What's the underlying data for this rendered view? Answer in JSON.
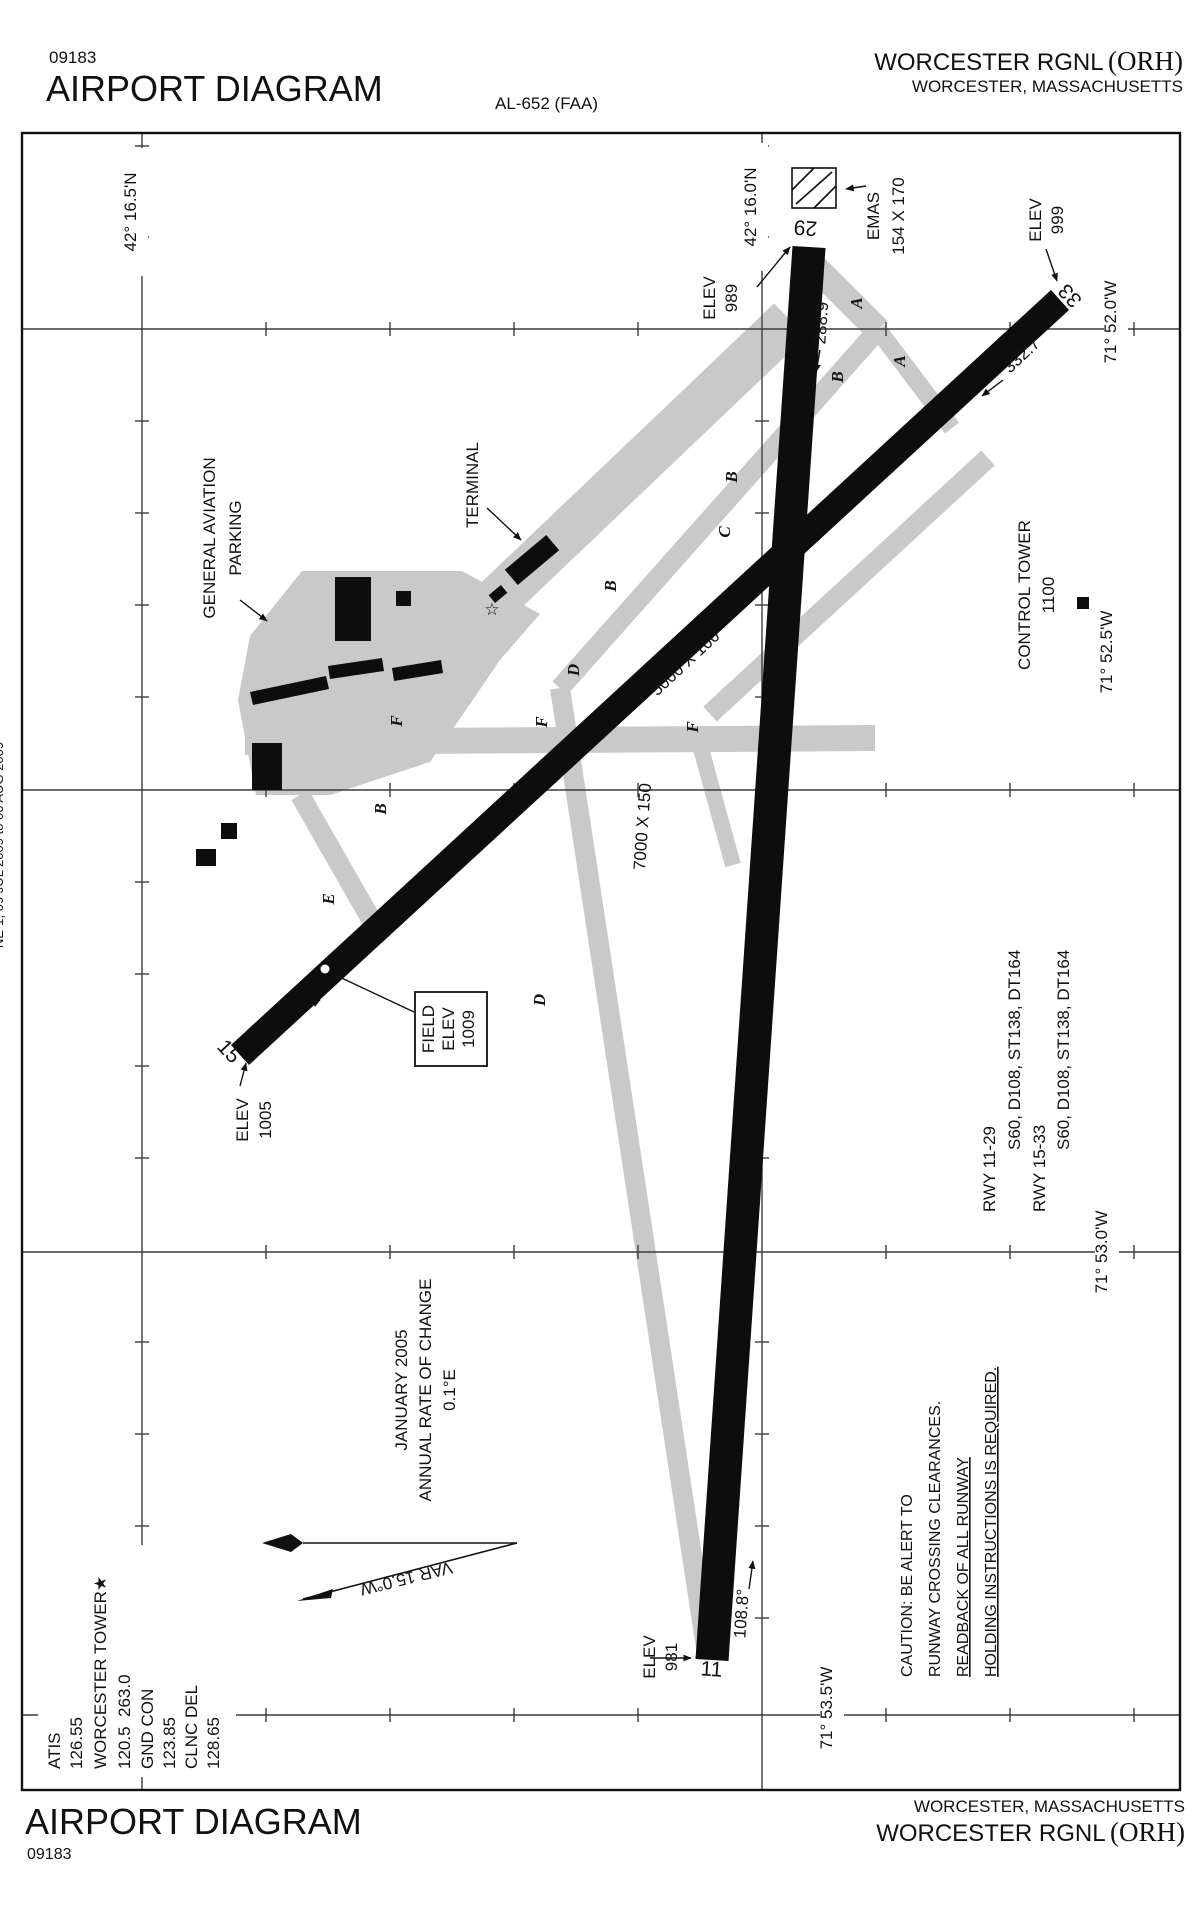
{
  "header": {
    "code": "09183",
    "title": "AIRPORT DIAGRAM",
    "al": "AL-652 (FAA)",
    "airport": "WORCESTER RGNL",
    "icao": "(ORH)",
    "city": "WORCESTER, MASSACHUSETTS"
  },
  "footer": {
    "title": "AIRPORT DIAGRAM",
    "code": "09183",
    "airport": "WORCESTER RGNL",
    "icao": "(ORH)",
    "city": "WORCESTER, MASSACHUSETTS"
  },
  "margin_text": "NE-1, 09 JUL 2009 to 06 AUG 2009",
  "grid": {
    "lat": [
      "42° 16.5'N",
      "42° 16.0'N"
    ],
    "lon": [
      "71° 52.0'W",
      "71° 52.5'W",
      "71° 53.0'W",
      "71° 53.5'W"
    ]
  },
  "runways": {
    "r11_29": {
      "dim": "7000 X 150",
      "end29": {
        "num": "29",
        "hdg": "288.9°",
        "elev_label": "ELEV",
        "elev": "989"
      },
      "end11": {
        "num": "11",
        "hdg": "108.8°",
        "elev_label": "ELEV",
        "elev": "981"
      }
    },
    "r15_33": {
      "dim": "5000 X 100",
      "end33": {
        "num": "33",
        "hdg": "332.7°",
        "elev_label": "ELEV",
        "elev": "999"
      },
      "end15": {
        "num": "15",
        "hdg": "152.7°",
        "elev_label": "ELEV",
        "elev": "1005"
      }
    }
  },
  "field_elev": {
    "l1": "FIELD",
    "l2": "ELEV",
    "l3": "1009"
  },
  "emas": {
    "l1": "EMAS",
    "l2": "154 X 170"
  },
  "tower": {
    "l1": "CONTROL TOWER",
    "l2": "1100"
  },
  "ga_parking": {
    "l1": "GENERAL AVIATION",
    "l2": "PARKING"
  },
  "terminal_label": "TERMINAL",
  "taxiways": {
    "a1": "A",
    "a2": "A",
    "b1": "B",
    "b2": "B",
    "b3": "B",
    "b4": "B",
    "c1": "C",
    "d1": "D",
    "d2": "D",
    "e1": "E",
    "f1": "F",
    "f2": "F",
    "f3": "F"
  },
  "rwy_data": {
    "l1": "RWY 11-29",
    "l2": "S60, D108, ST138, DT164",
    "l3": "RWY 15-33",
    "l4": "S60, D108, ST138, DT164"
  },
  "caution": {
    "l1": "CAUTION: BE ALERT TO",
    "l2": "RUNWAY CROSSING CLEARANCES.",
    "l3": "READBACK OF ALL RUNWAY",
    "l4": "HOLDING INSTRUCTIONS IS REQUIRED."
  },
  "variation": {
    "l1": "JANUARY 2005",
    "l2": "ANNUAL RATE OF CHANGE",
    "l3": "0.1°E",
    "var_label": "VAR 15.0°W"
  },
  "freqs": {
    "l1": "ATIS",
    "l2": "126.55",
    "l3": "WORCESTER TOWER★",
    "l4": "120.5  263.0",
    "l5": "GND CON",
    "l6": "123.85",
    "l7": "CLNC DEL",
    "l8": "128.65"
  }
}
